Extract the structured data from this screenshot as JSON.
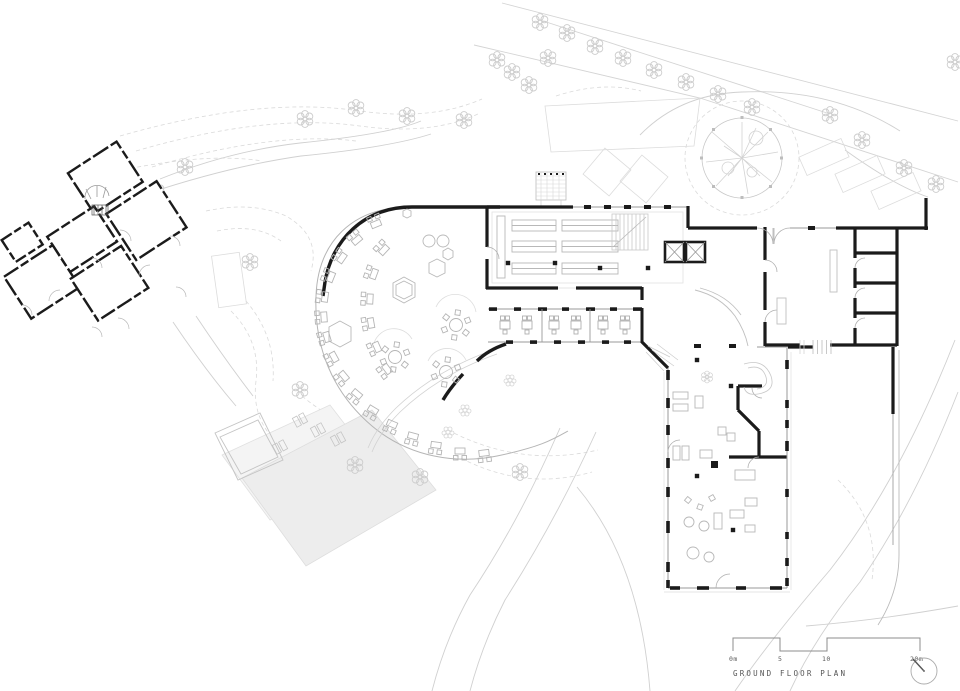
{
  "drawing": {
    "title": "GROUND FLOOR PLAN",
    "scale_bar": {
      "labels": [
        "0m",
        "5",
        "10",
        "20m"
      ]
    },
    "icons": {
      "north_arrow": "north-arrow-icon",
      "tree": "tree-icon",
      "big_tree": "big-tree-icon"
    },
    "colors": {
      "walls": "#1b1b1b",
      "furniture": "#b5b5b5",
      "site_lines": "#cfcfcf",
      "site_light": "#e0e0e0",
      "terrace_fill": "#ededed",
      "annotation": "#5a5a5a",
      "background": "#ffffff"
    }
  }
}
